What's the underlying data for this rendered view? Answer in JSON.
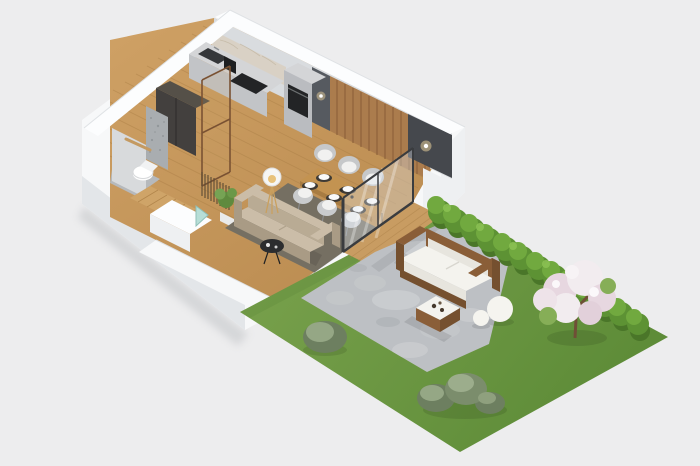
{
  "meta": {
    "kind": "isometric-3d-floorplan-render",
    "width_px": 700,
    "height_px": 466
  },
  "colors": {
    "background": "#ededee",
    "wallWhite": "#f7f8f9",
    "wallTop": "#fcfdfe",
    "wallFaceLight": "#eef0f2",
    "wallFaceMid": "#e3e6e9",
    "wallFaceDark": "#d9dcdf",
    "floorWood": "#cfa165",
    "floorWoodDark": "#b98a4f",
    "slatWood": "#ab7c4d",
    "panelDark": "#45484d",
    "panelMid": "#565a60",
    "counterTop": "#d4d5d7",
    "counterFace": "#c2c4c7",
    "cabinetColumn": "#babcc0",
    "applianceDark": "#232426",
    "marble": "#d9d1c5",
    "wardrobe": "#43403e",
    "wardrobeTop": "#555048",
    "bathWallGray": "#a9adb0",
    "bathWallLight": "#d8dadc",
    "bathFloorTile": "#b6b9bc",
    "toiletWhite": "#fdfdfd",
    "towelWood": "#c49a62",
    "stairWood": "#cfa468",
    "rug": "#756f62",
    "sofaTop": "#cbbda8",
    "sofaFront": "#b9ab94",
    "sofaSide": "#a99b85",
    "tableWood": "#c39351",
    "tableEdge": "#a87c42",
    "chairShell": "#c6c8ca",
    "chairSeat": "#f1f1f0",
    "placemat": "#3e3a35",
    "plate": "#fafafa",
    "lampWhite": "#f6f6f4",
    "lampWarm": "#e8c27a",
    "tealGlass": "#b7ded7",
    "glassTint": "#dfe9f0",
    "plantGreen": "#5f8a3e",
    "plantGreenLight": "#76a354",
    "grassLight": "#7ba34e",
    "grassDark": "#5e8c38",
    "hedgeDark": "#4a7629",
    "hedgeMid": "#5d9234",
    "hedgeLight": "#71a93f",
    "hedgeHi": "#8cc254",
    "patioBase": "#bdc0c4",
    "patioLight": "#ced1d4",
    "patioDark": "#a7abaf",
    "deckWood": "#c89c62",
    "outdoorWood": "#8a5e38",
    "outdoorWoodDark": "#75502f",
    "cushionWhite": "#f4f3ee",
    "cushionShade": "#e7e5de",
    "blossomLight": "#f2ecef",
    "blossomPink": "#e7d7e0",
    "treeGreen": "#86ae57",
    "trunk": "#6f4f36",
    "bushLight": "#95a785",
    "bushDark": "#6d7f60",
    "sphereWhite": "#f5f4ef",
    "sconceGlow": "#f3d9a2"
  },
  "objects": {
    "building": [
      "kitchen counter",
      "cooktop",
      "sink",
      "oven column",
      "coffee machine",
      "tall wardrobe",
      "bronze glass partition",
      "wood slat accent wall",
      "dark wall panel with sconce",
      "bathroom toilet",
      "bathroom stone wall",
      "towel bar",
      "staircase",
      "stair railing",
      "stairwell glass",
      "potted plant",
      "dining table",
      "six dining chairs",
      "six place settings",
      "fabric sofa",
      "round side table",
      "tripod floor lamp",
      "area rug",
      "sliding glass wall"
    ],
    "garden": [
      "stone patio",
      "wood deck strip",
      "outdoor wicker sofa with white cushions",
      "outdoor coffee table with tray",
      "two sphere lamps",
      "trimmed hedge",
      "blossoming tree",
      "three round bushes",
      "single bush",
      "lawn"
    ]
  }
}
